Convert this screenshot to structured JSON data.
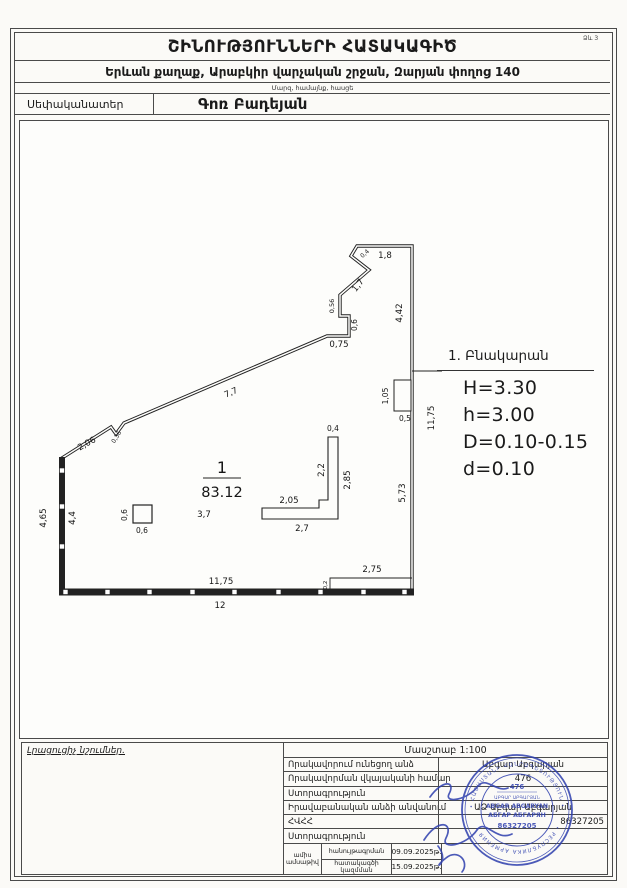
{
  "form_label": "Ձև 3",
  "header": {
    "title": "ՇԻՆՈՒԹՅՈՒՆՆԵՐԻ ՀԱՏԱԿԱԳԻԾ",
    "address": "Երևան քաղաք, Արաբկիր վարչական շրջան, Զարյան փողոց 140",
    "address_caption": "Մարզ, համայնք, հասցե",
    "owner_label": "Սեփականատեր",
    "owner_name": "Գոռ Բադեյան"
  },
  "plan": {
    "room_number": "1",
    "room_area": "83.12",
    "dimensions": [
      {
        "t": "1,8",
        "x": 385,
        "y": 258
      },
      {
        "t": "0,4",
        "x": 366,
        "y": 255,
        "r": -42,
        "s": 6
      },
      {
        "t": "1,7",
        "x": 360,
        "y": 287,
        "r": -52
      },
      {
        "t": "4,42",
        "x": 402,
        "y": 313,
        "r": -90
      },
      {
        "t": "0,56",
        "x": 334,
        "y": 306,
        "r": -90,
        "s": 6.5
      },
      {
        "t": "0,6",
        "x": 357,
        "y": 325,
        "r": -90,
        "s": 7.5
      },
      {
        "t": "0,75",
        "x": 339,
        "y": 347
      },
      {
        "t": "7,7",
        "x": 232,
        "y": 395,
        "r": -24
      },
      {
        "t": "0,36",
        "x": 118,
        "y": 438,
        "r": -58,
        "s": 6
      },
      {
        "t": "2,06",
        "x": 88,
        "y": 446,
        "r": -29
      },
      {
        "t": "4,65",
        "x": 46,
        "y": 518,
        "r": -90
      },
      {
        "t": "4,4",
        "x": 75,
        "y": 518,
        "r": -90
      },
      {
        "t": "11,75",
        "x": 221,
        "y": 584
      },
      {
        "t": "12",
        "x": 220,
        "y": 608
      },
      {
        "t": "2,75",
        "x": 372,
        "y": 572
      },
      {
        "t": "0,2",
        "x": 327,
        "y": 585,
        "r": -90,
        "s": 5.5
      },
      {
        "t": "11,75",
        "x": 434,
        "y": 418,
        "r": -90
      },
      {
        "t": "5,73",
        "x": 405,
        "y": 493,
        "r": -90
      },
      {
        "t": "1,05",
        "x": 388,
        "y": 396,
        "r": -90,
        "s": 7.5
      },
      {
        "t": "0,5",
        "x": 405,
        "y": 421,
        "s": 7.5
      },
      {
        "t": "0,4",
        "x": 333,
        "y": 431,
        "s": 7.5
      },
      {
        "t": "2,2",
        "x": 324,
        "y": 470,
        "r": -90
      },
      {
        "t": "2,85",
        "x": 350,
        "y": 480,
        "r": -90
      },
      {
        "t": "2,05",
        "x": 289,
        "y": 503
      },
      {
        "t": "2,7",
        "x": 302,
        "y": 531
      },
      {
        "t": "3,7",
        "x": 204,
        "y": 517
      },
      {
        "t": "0,6",
        "x": 127,
        "y": 515,
        "r": -90,
        "s": 7.5
      },
      {
        "t": "0,6",
        "x": 142,
        "y": 533,
        "s": 7.5
      }
    ]
  },
  "info": {
    "room_title": "1. Բնակարան",
    "lines": [
      "H=3.30",
      "h=3.00",
      "D=0.10-0.15",
      "d=0.10"
    ]
  },
  "footer": {
    "notes_label": "Լրացուցիչ նշումներ.",
    "scale_label": "Մասշտաբ 1:100",
    "rows": [
      {
        "label": "Որակավորում ունեցող անձ",
        "value": "Աբգար Աբգարյան"
      },
      {
        "label": "Որակավորման վկայականի համար",
        "value": "476"
      },
      {
        "label": "Ստորագրություն",
        "value": ""
      },
      {
        "label": "Իրավաբանական անձի անվանում",
        "value": "ԱՁ Աբգար Աբգարյան"
      },
      {
        "label": "ՀՎՀՀ",
        "value": "86327205"
      },
      {
        "label": "Ստորագրություն",
        "value": ""
      }
    ],
    "date_row": {
      "left_label_line1": "ամիս",
      "left_label_line2": "ամսաթիվ",
      "survey_label": "հանույթագրման",
      "survey_date": "09.09.2025թ.",
      "plan_label": "հատակագծի կազմման",
      "plan_date": "15.09.2025թ."
    }
  },
  "stamp": {
    "reg_number": "476",
    "name_hy": "ԱԲԳԱՐ ԱԲԳԱՐՅԱՆ",
    "name_en": "ABGAR ABGARYAN",
    "name_ru": "АБГАР АБГАРЯН",
    "id_number": "86327205",
    "ring_top": "• ՀԱՅԱՍՏԱՆԻ ՀԱՆՐԱՊԵՏՈՒԹՅՈՒՆ •",
    "ring_bottom": "• РЕСПУБЛИКА АРМЕНИЯ •",
    "color": "#2e3fae"
  }
}
